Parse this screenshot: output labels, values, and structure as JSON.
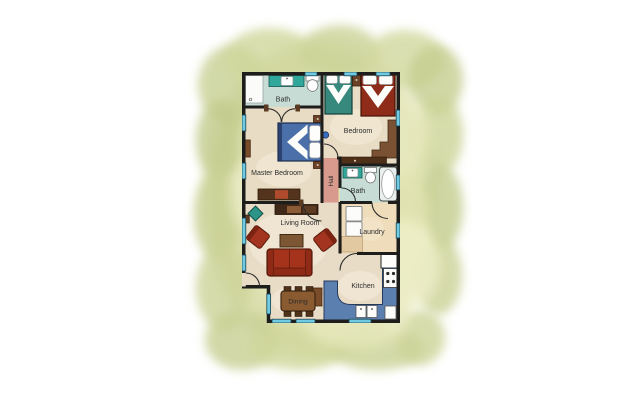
{
  "rooms": {
    "bath_top": {
      "label": "Bath"
    },
    "bedroom": {
      "label": "Bedroom"
    },
    "master_bedroom": {
      "label": "Master Bedroom"
    },
    "hall": {
      "label": "Hall"
    },
    "bath_middle": {
      "label": "Bath"
    },
    "living_room": {
      "label": "Living Room"
    },
    "laundry": {
      "label": "Laundry"
    },
    "kitchen": {
      "label": "Kitchen"
    },
    "dining": {
      "label": "Dining"
    }
  },
  "palette": {
    "background_green": "#d7dca6",
    "wall_black": "#1d1d1b",
    "floor_tan": "#e9dcc4",
    "floor_bath_teal": "#c6dcd4",
    "floor_hall_salmon": "#d89a8c",
    "floor_laundry_peach": "#efdcbb",
    "window_cyan": "#6fcbe4",
    "kitchen_counter_blue": "#5b80af",
    "sofa_red": "#a5331c",
    "master_bed_blue": "#4b70a9",
    "bed_teal": "#37897d",
    "bed_red": "#8e2c19",
    "vanity_teal": "#2fa79b",
    "wood_brown": "#7a4c2a"
  }
}
